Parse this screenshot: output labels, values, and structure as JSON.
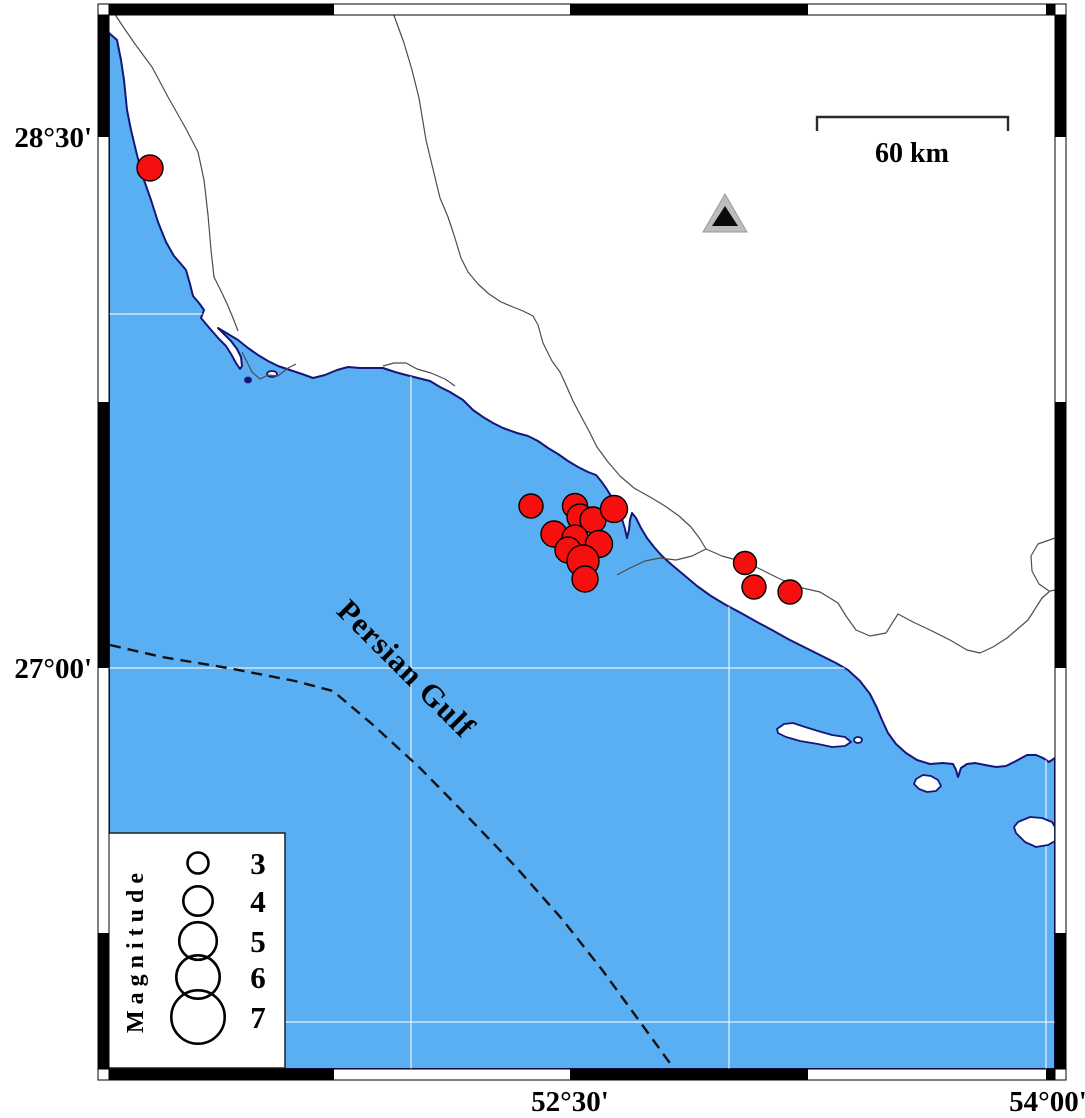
{
  "map": {
    "sea_label": "Persian Gulf",
    "scale_bar": {
      "label": "60 km",
      "x1": 817,
      "x2": 1008,
      "y": 117,
      "tick_len": 14,
      "label_x": 912,
      "label_y": 162
    },
    "axis_labels": {
      "lat": [
        {
          "text": "28°30'",
          "y": 137
        },
        {
          "text": "27°00'",
          "y": 668
        }
      ],
      "lon": [
        {
          "text": "52°30'",
          "x": 570
        },
        {
          "text": "54°00'",
          "x": 1048
        }
      ]
    },
    "legend": {
      "title": "Magnitude",
      "items": [
        {
          "mag": "3",
          "r": 10.5,
          "cy": 863
        },
        {
          "mag": "4",
          "r": 14.7,
          "cy": 901
        },
        {
          "mag": "5",
          "r": 18.8,
          "cy": 941
        },
        {
          "mag": "6",
          "r": 21.7,
          "cy": 977
        },
        {
          "mag": "7",
          "r": 26.7,
          "cy": 1017
        }
      ],
      "circle_cx": 198,
      "num_x": 258,
      "box": {
        "x": 108,
        "y": 833,
        "w": 177,
        "h": 235
      }
    },
    "quakes": [
      {
        "x": 150,
        "y": 168,
        "r": 13
      },
      {
        "x": 531,
        "y": 506,
        "r": 12
      },
      {
        "x": 575,
        "y": 506,
        "r": 12.5
      },
      {
        "x": 580,
        "y": 517,
        "r": 13
      },
      {
        "x": 593,
        "y": 520,
        "r": 13
      },
      {
        "x": 614,
        "y": 509,
        "r": 13.5
      },
      {
        "x": 554,
        "y": 534,
        "r": 13
      },
      {
        "x": 575,
        "y": 538,
        "r": 13
      },
      {
        "x": 599,
        "y": 544,
        "r": 13.5
      },
      {
        "x": 568,
        "y": 550,
        "r": 13
      },
      {
        "x": 583,
        "y": 561,
        "r": 16
      },
      {
        "x": 585,
        "y": 579,
        "r": 13
      },
      {
        "x": 745,
        "y": 563,
        "r": 11.5
      },
      {
        "x": 754,
        "y": 587,
        "r": 12
      },
      {
        "x": 790,
        "y": 592,
        "r": 12
      }
    ],
    "station_triangle": {
      "x": 725,
      "y": 214
    },
    "frame": {
      "inner": {
        "x1": 109,
        "y1": 15,
        "x2": 1055,
        "y2": 1069
      },
      "bar": 11,
      "x_ticks": [
        334,
        570,
        808,
        1046
      ],
      "y_ticks": [
        137,
        402,
        668,
        933
      ],
      "grid_x": [
        411,
        729,
        1046
      ],
      "grid_y": [
        314,
        668,
        1022
      ]
    },
    "colors": {
      "sea": "#5AAEF2",
      "land": "#FFFFFF",
      "coast": "#16167A",
      "grid": "#FFFFFF",
      "quake_fill": "#F50F0F",
      "quake_stroke": "#000000",
      "thin_line": "#4D4D4D",
      "dash_line": "#111111",
      "triangle_fill": "#BCBCBC",
      "triangle_edge": "#9A9A9A",
      "triangle_inner": "#0A0A0A",
      "frame_black": "#000000",
      "frame_white": "#FFFFFF"
    }
  }
}
